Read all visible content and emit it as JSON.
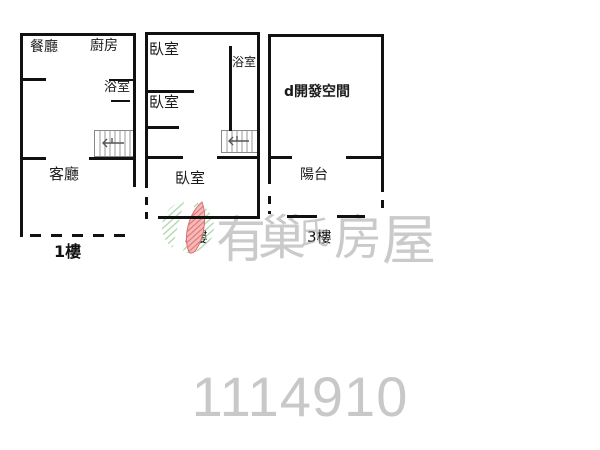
{
  "floor1": {
    "label": "1樓",
    "dining": "餐廳",
    "kitchen": "廚房",
    "bathroom": "浴室",
    "living": "客廳"
  },
  "floor2": {
    "label": "2樓",
    "bedroom_top": "臥室",
    "bathroom": "浴室",
    "bedroom_mid": "臥室",
    "bedroom_bottom": "臥室"
  },
  "floor3": {
    "label": "3樓",
    "space": "d開發空間",
    "balcony": "陽台"
  },
  "watermark": {
    "brand": "有巢氏房屋",
    "chars": [
      "有",
      "巢",
      "氏",
      "房",
      "屋"
    ],
    "logo": "u-trust-leaf-logo"
  },
  "listing_id": "1114910",
  "colors": {
    "wall": "#111111",
    "watermark_text": "#c3c3c3",
    "listing_id_text": "#c8c8c8",
    "logo_green": "#8fc98f",
    "logo_red": "#ef8484"
  }
}
